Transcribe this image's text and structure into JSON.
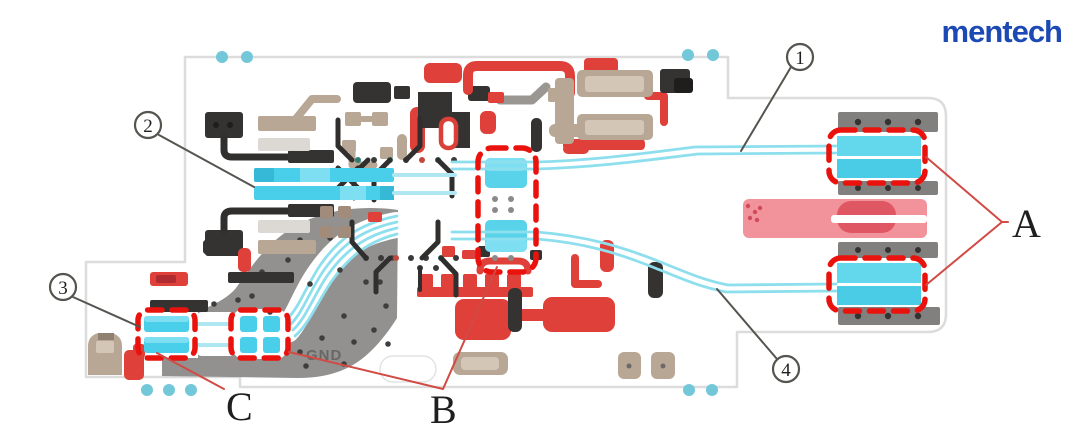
{
  "brand": {
    "logo_text": "mentech",
    "logo_color": "#1d49b5"
  },
  "pcb_board": {
    "silkscreen_label": "GND"
  },
  "callouts": {
    "c1": "1",
    "c2": "2",
    "c3": "3",
    "c4": "4"
  },
  "region_labels": {
    "a": "A",
    "b": "B",
    "c": "C"
  },
  "colors": {
    "trace_cyan": "#49cfe9",
    "pale_cyan": "#8edfee",
    "highlight_dash_red": "#ea120c",
    "component_red": "#df4039",
    "component_dark": "#343332",
    "component_tan": "#b9a795",
    "ground_plane_gray": "#929190",
    "connector_bar_gray": "#82807f",
    "laser_pad_pink": "#f2929b",
    "annotation_red": "#d14a44",
    "annotation_dark": "#55544f",
    "board_outline_gray": "#dcdcdc",
    "mount_hole_cyan": "#72c7d9"
  }
}
